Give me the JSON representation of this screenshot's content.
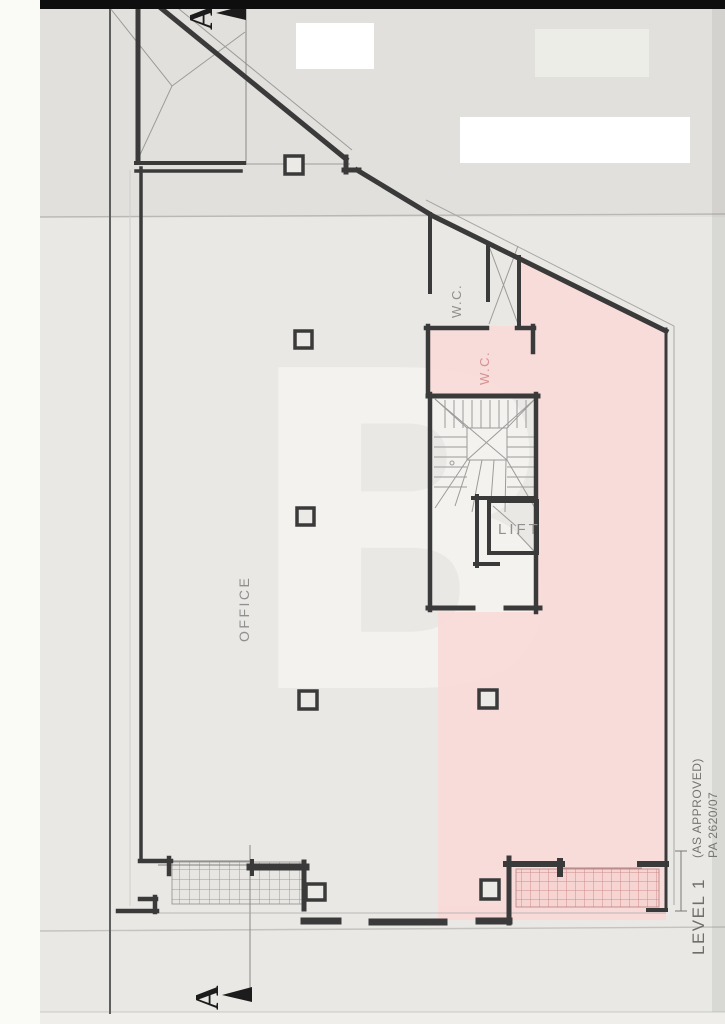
{
  "plan": {
    "watermark": "B",
    "rooms": {
      "office": "OFFICE",
      "wc_upper": "W.C.",
      "wc_lower": "W.C.",
      "lift": "LIFT"
    },
    "section_markers": {
      "top": "A",
      "bottom": "A"
    },
    "title_block": {
      "level": "LEVEL 1",
      "status": "(AS APPROVED)",
      "reference": "PA 2620/07"
    },
    "colors": {
      "scan_edge": "#0e0e0e",
      "scanner_strip": "#fafaf7",
      "paper": "#e9e8e4",
      "wall": "#3a3a3a",
      "thin_line": "#9b9b9b",
      "highlight_pink": "#f8dad8",
      "hatch_red": "#cf8b8b",
      "hatch_gray": "#9a9a9a",
      "text_gray": "#8f8f8f",
      "text_pink": "#d79191",
      "marker_black": "#1c1c1c",
      "whiteout": "#ffffff"
    }
  }
}
